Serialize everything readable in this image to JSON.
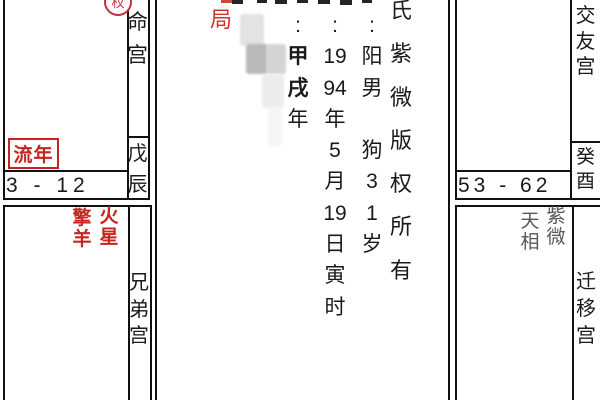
{
  "colors": {
    "accent_red": "#c5241f",
    "bureau_red": "#cf332c",
    "text_black": "#1a1a1a",
    "muted_star_gray": "#575757",
    "grid_border": "#111111"
  },
  "left_top_cell": {
    "palace": "命宫",
    "stem_branch": "戊辰",
    "age_range": "3 - 12",
    "annual_marker": "流年",
    "transform_badge": "权"
  },
  "left_bottom_cell": {
    "palace": "兄弟宫",
    "star_1": "擎羊",
    "star_2": "火星"
  },
  "right_top_cell": {
    "palace": "交友宫",
    "stem_branch": "癸酉",
    "age_range": "53 - 62"
  },
  "right_bottom_cell": {
    "palace": "迁移宫",
    "star_1": "紫微",
    "star_2": "天相"
  },
  "center_panel": {
    "bureau_label": "局",
    "year_pillar_column": {
      "cells": [
        ":",
        "甲",
        "戌",
        "年"
      ]
    },
    "birth_date_column": {
      "cells": [
        ":",
        "19",
        "94",
        "年",
        "5",
        "月",
        "19",
        "日",
        "寅",
        "时"
      ]
    },
    "gender_column": {
      "cells": [
        ":",
        "阳",
        "男",
        "",
        "狗",
        "3",
        "1",
        "岁"
      ]
    },
    "watermark_column": {
      "cells": [
        "氏",
        "紫",
        "微",
        "版",
        "权",
        "所",
        "有"
      ]
    }
  }
}
